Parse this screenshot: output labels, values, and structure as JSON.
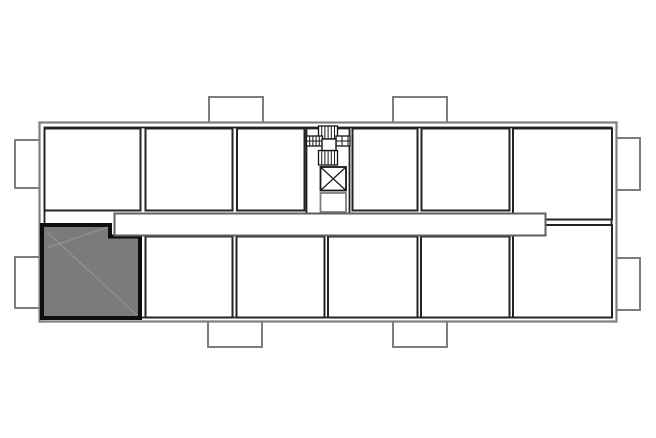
{
  "floorplan": {
    "canvas": {
      "width": 656,
      "height": 438
    },
    "colors": {
      "white": "#ffffff",
      "none": "none",
      "outer": "#7e7e7e",
      "wall": "#232323",
      "corridor": "#5f5f5f",
      "stair": "#161616",
      "highlight_fill": "#7b7b7b",
      "highlight_border": "#0e0e0e",
      "streak": "rgba(255,255,255,0.16)"
    },
    "elements": [
      {
        "kind": "rect",
        "name": "balcony-left-top",
        "interactable": false,
        "x": 15,
        "y": 140,
        "w": 25,
        "h": 48,
        "stroke": "outer",
        "sw": 2,
        "fill": "white"
      },
      {
        "kind": "rect",
        "name": "balcony-left-bottom",
        "interactable": false,
        "x": 15,
        "y": 257,
        "w": 25,
        "h": 51,
        "stroke": "outer",
        "sw": 2,
        "fill": "white"
      },
      {
        "kind": "rect",
        "name": "balcony-top-left",
        "interactable": false,
        "x": 209,
        "y": 97,
        "w": 54,
        "h": 27,
        "stroke": "outer",
        "sw": 2,
        "fill": "white"
      },
      {
        "kind": "rect",
        "name": "balcony-top-right",
        "interactable": false,
        "x": 393,
        "y": 97,
        "w": 54,
        "h": 27,
        "stroke": "outer",
        "sw": 2,
        "fill": "white"
      },
      {
        "kind": "rect",
        "name": "balcony-bottom-left",
        "interactable": false,
        "x": 208,
        "y": 321,
        "w": 54,
        "h": 26,
        "stroke": "outer",
        "sw": 2,
        "fill": "white"
      },
      {
        "kind": "rect",
        "name": "balcony-bottom-right",
        "interactable": false,
        "x": 393,
        "y": 321,
        "w": 54,
        "h": 26,
        "stroke": "outer",
        "sw": 2,
        "fill": "white"
      },
      {
        "kind": "rect",
        "name": "balcony-right-top",
        "interactable": false,
        "x": 616,
        "y": 138,
        "w": 24,
        "h": 52,
        "stroke": "outer",
        "sw": 2,
        "fill": "white"
      },
      {
        "kind": "rect",
        "name": "balcony-right-bottom",
        "interactable": false,
        "x": 616,
        "y": 258,
        "w": 24,
        "h": 52,
        "stroke": "outer",
        "sw": 2,
        "fill": "white"
      },
      {
        "kind": "rect",
        "name": "building-wall-outer",
        "interactable": false,
        "x": 39.5,
        "y": 122.5,
        "w": 577,
        "h": 199,
        "stroke": "outer",
        "sw": 2.2,
        "fill": "white"
      },
      {
        "kind": "rect",
        "name": "building-wall-inner",
        "interactable": false,
        "x": 44.5,
        "y": 127.5,
        "w": 567,
        "h": 190,
        "stroke": "wall",
        "sw": 1.8,
        "fill": "none"
      },
      {
        "kind": "rect",
        "name": "room-top-1",
        "interactable": true,
        "x": 44.5,
        "y": 128.5,
        "w": 96,
        "h": 82,
        "stroke": "wall",
        "sw": 2,
        "fill": "white"
      },
      {
        "kind": "rect",
        "name": "room-top-2",
        "interactable": true,
        "x": 145.5,
        "y": 128.5,
        "w": 87,
        "h": 82,
        "stroke": "wall",
        "sw": 2,
        "fill": "white"
      },
      {
        "kind": "rect",
        "name": "room-top-3",
        "interactable": true,
        "x": 237,
        "y": 128.5,
        "w": 67.5,
        "h": 82,
        "stroke": "wall",
        "sw": 2,
        "fill": "white"
      },
      {
        "kind": "rect",
        "name": "stair-core-column",
        "interactable": false,
        "x": 306.5,
        "y": 128.5,
        "w": 43,
        "h": 85,
        "stroke": "wall",
        "sw": 1.8,
        "fill": "white"
      },
      {
        "kind": "rect",
        "name": "room-top-4",
        "interactable": true,
        "x": 352.5,
        "y": 128.5,
        "w": 65,
        "h": 82,
        "stroke": "wall",
        "sw": 2,
        "fill": "white"
      },
      {
        "kind": "rect",
        "name": "room-top-5",
        "interactable": true,
        "x": 421.5,
        "y": 128.5,
        "w": 88,
        "h": 82,
        "stroke": "wall",
        "sw": 2,
        "fill": "white"
      },
      {
        "kind": "rect",
        "name": "room-top-6",
        "interactable": true,
        "x": 513,
        "y": 128.5,
        "w": 99,
        "h": 91,
        "stroke": "wall",
        "sw": 2,
        "fill": "white"
      },
      {
        "kind": "rect",
        "name": "room-bottom-2",
        "interactable": true,
        "x": 145.5,
        "y": 236.5,
        "w": 87,
        "h": 81,
        "stroke": "wall",
        "sw": 2,
        "fill": "white"
      },
      {
        "kind": "rect",
        "name": "room-bottom-3",
        "interactable": true,
        "x": 236.5,
        "y": 236.5,
        "w": 88,
        "h": 81,
        "stroke": "wall",
        "sw": 2,
        "fill": "white"
      },
      {
        "kind": "rect",
        "name": "room-bottom-4",
        "interactable": true,
        "x": 328,
        "y": 236.5,
        "w": 89.5,
        "h": 81,
        "stroke": "wall",
        "sw": 2,
        "fill": "white"
      },
      {
        "kind": "rect",
        "name": "room-bottom-5",
        "interactable": true,
        "x": 421,
        "y": 236.5,
        "w": 88.5,
        "h": 81,
        "stroke": "wall",
        "sw": 2,
        "fill": "white"
      },
      {
        "kind": "rect",
        "name": "room-bottom-6",
        "interactable": true,
        "x": 513,
        "y": 225,
        "w": 99,
        "h": 92.5,
        "stroke": "wall",
        "sw": 2,
        "fill": "white"
      },
      {
        "kind": "hatch",
        "name": "stair-flight-top",
        "interactable": false,
        "x": 318.5,
        "y": 126,
        "w": 19,
        "h": 13,
        "step": 3.2,
        "mid": false,
        "stroke": "stair",
        "sw": 1.3,
        "fill": "white"
      },
      {
        "kind": "hatch",
        "name": "stair-flight-bottom",
        "interactable": false,
        "x": 318.5,
        "y": 150.5,
        "w": 19,
        "h": 14.5,
        "step": 3.2,
        "mid": false,
        "stroke": "stair",
        "sw": 1.3,
        "fill": "white"
      },
      {
        "kind": "hatch",
        "name": "stair-flight-left",
        "interactable": false,
        "x": 306.5,
        "y": 136,
        "w": 16,
        "h": 10,
        "step": 3.2,
        "mid": true,
        "stroke": "stair",
        "sw": 1.3,
        "fill": "white"
      },
      {
        "kind": "hatch",
        "name": "stair-flight-right",
        "interactable": false,
        "x": 336,
        "y": 136,
        "w": 14,
        "h": 10,
        "step": 6,
        "mid": true,
        "stroke": "stair",
        "sw": 1.3,
        "fill": "white"
      },
      {
        "kind": "rect",
        "name": "stair-landing",
        "interactable": false,
        "x": 322,
        "y": 139,
        "w": 14,
        "h": 11.5,
        "stroke": "stair",
        "sw": 1.4,
        "fill": "white"
      },
      {
        "kind": "xbox",
        "name": "elevator-shaft-icon",
        "interactable": false,
        "x": 320.5,
        "y": 167,
        "w": 25.5,
        "h": 23.5,
        "stroke": "stair",
        "sw": 1.8,
        "fill": "white"
      },
      {
        "kind": "rect",
        "name": "service-shaft",
        "interactable": false,
        "x": 320.5,
        "y": 193,
        "w": 25.5,
        "h": 19,
        "stroke": "outer",
        "sw": 1.8,
        "fill": "white"
      },
      {
        "kind": "polygon",
        "name": "highlighted-unit",
        "interactable": true,
        "points": "42,225 110,225 110,236.5 140,236.5 140,318 42,318",
        "stroke": "highlight_border",
        "sw": 4,
        "fill": "highlight_fill"
      },
      {
        "kind": "line",
        "name": "highlighted-unit-streak-1",
        "interactable": false,
        "x1": 47,
        "y1": 232,
        "x2": 137,
        "y2": 315,
        "stroke": "streak",
        "sw": 1.4
      },
      {
        "kind": "line",
        "name": "highlighted-unit-streak-2",
        "interactable": false,
        "x1": 47,
        "y1": 248,
        "x2": 108,
        "y2": 227,
        "stroke": "streak",
        "sw": 1.4
      },
      {
        "kind": "rect",
        "name": "corridor",
        "interactable": false,
        "x": 114.5,
        "y": 213.5,
        "w": 431,
        "h": 22,
        "stroke": "corridor",
        "sw": 2,
        "fill": "white"
      }
    ]
  }
}
